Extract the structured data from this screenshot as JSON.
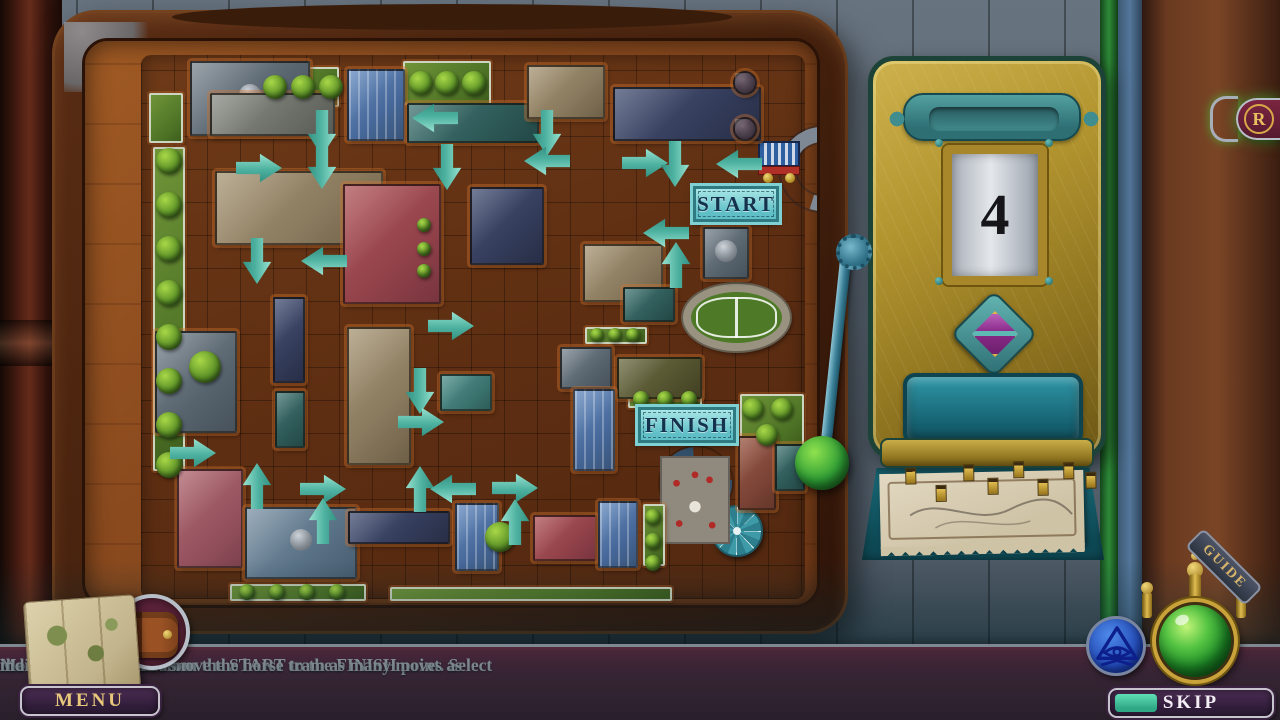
{
  "colors": {
    "arrow_teal": "#4fb8a8",
    "machine_gold": "#b3952f",
    "bar_maroon": "#6b1f33",
    "orb_green": "#2ea03a",
    "sign_teal": "#8adde0",
    "eye_blue": "#1b3fae"
  },
  "instructions": {
    "lines": [
      "Move the horse tram from the START to the FINISH point. Select",
      "the number buttons to move the horse tram as many moves as",
      "indicated by the arrows."
    ]
  },
  "board": {
    "start_label": "START",
    "finish_label": "FINISH",
    "arrows": [
      {
        "x": 237,
        "y": 92,
        "d": "d"
      },
      {
        "x": 237,
        "y": 125,
        "d": "d"
      },
      {
        "x": 174,
        "y": 127,
        "d": "r"
      },
      {
        "x": 362,
        "y": 126,
        "d": "d"
      },
      {
        "x": 462,
        "y": 92,
        "d": "d"
      },
      {
        "x": 462,
        "y": 120,
        "d": "l"
      },
      {
        "x": 560,
        "y": 122,
        "d": "r"
      },
      {
        "x": 590,
        "y": 123,
        "d": "d"
      },
      {
        "x": 654,
        "y": 123,
        "d": "l"
      },
      {
        "x": 350,
        "y": 77,
        "d": "l"
      },
      {
        "x": 172,
        "y": 220,
        "d": "d"
      },
      {
        "x": 239,
        "y": 220,
        "d": "l"
      },
      {
        "x": 581,
        "y": 192,
        "d": "l"
      },
      {
        "x": 591,
        "y": 224,
        "d": "u"
      },
      {
        "x": 366,
        "y": 285,
        "d": "r"
      },
      {
        "x": 335,
        "y": 350,
        "d": "d"
      },
      {
        "x": 336,
        "y": 381,
        "d": "r"
      },
      {
        "x": 108,
        "y": 412,
        "d": "r"
      },
      {
        "x": 172,
        "y": 445,
        "d": "u"
      },
      {
        "x": 238,
        "y": 448,
        "d": "r"
      },
      {
        "x": 335,
        "y": 448,
        "d": "u"
      },
      {
        "x": 368,
        "y": 448,
        "d": "l"
      },
      {
        "x": 430,
        "y": 447,
        "d": "r"
      },
      {
        "x": 238,
        "y": 480,
        "d": "u"
      },
      {
        "x": 430,
        "y": 481,
        "d": "u"
      }
    ],
    "buildings": [
      {
        "x": 105,
        "y": 20,
        "w": 120,
        "h": 75,
        "c": "slate",
        "dome": true
      },
      {
        "x": 125,
        "y": 52,
        "w": 125,
        "h": 43,
        "c": "slate2"
      },
      {
        "x": 262,
        "y": 28,
        "w": 58,
        "h": 72,
        "c": "blue"
      },
      {
        "x": 322,
        "y": 62,
        "w": 132,
        "h": 40,
        "c": "dteal"
      },
      {
        "x": 442,
        "y": 24,
        "w": 78,
        "h": 54,
        "c": "tan"
      },
      {
        "x": 528,
        "y": 46,
        "w": 148,
        "h": 54,
        "c": "navy"
      },
      {
        "x": 648,
        "y": 30,
        "w": 24,
        "h": 24,
        "c": "plum"
      },
      {
        "x": 648,
        "y": 76,
        "w": 24,
        "h": 24,
        "c": "plum"
      },
      {
        "x": 130,
        "y": 130,
        "w": 168,
        "h": 74,
        "c": "tan"
      },
      {
        "x": 258,
        "y": 143,
        "w": 98,
        "h": 120,
        "c": "red"
      },
      {
        "x": 385,
        "y": 146,
        "w": 74,
        "h": 78,
        "c": "navy"
      },
      {
        "x": 618,
        "y": 186,
        "w": 46,
        "h": 52,
        "c": "slate",
        "dome": true
      },
      {
        "x": 70,
        "y": 290,
        "w": 82,
        "h": 102,
        "c": "slate"
      },
      {
        "x": 188,
        "y": 256,
        "w": 32,
        "h": 86,
        "c": "navy"
      },
      {
        "x": 190,
        "y": 350,
        "w": 30,
        "h": 57,
        "c": "dteal"
      },
      {
        "x": 262,
        "y": 286,
        "w": 64,
        "h": 138,
        "c": "tan"
      },
      {
        "x": 355,
        "y": 333,
        "w": 52,
        "h": 37,
        "c": "teal"
      },
      {
        "x": 498,
        "y": 203,
        "w": 80,
        "h": 58,
        "c": "tan"
      },
      {
        "x": 538,
        "y": 246,
        "w": 52,
        "h": 35,
        "c": "dteal"
      },
      {
        "x": 475,
        "y": 306,
        "w": 52,
        "h": 42,
        "c": "slate"
      },
      {
        "x": 532,
        "y": 316,
        "w": 85,
        "h": 42,
        "c": "olive"
      },
      {
        "x": 488,
        "y": 348,
        "w": 42,
        "h": 82,
        "c": "blue"
      },
      {
        "x": 92,
        "y": 428,
        "w": 66,
        "h": 99,
        "c": "pink"
      },
      {
        "x": 160,
        "y": 466,
        "w": 112,
        "h": 72,
        "c": "steel",
        "dome": true
      },
      {
        "x": 263,
        "y": 470,
        "w": 102,
        "h": 33,
        "c": "navy"
      },
      {
        "x": 370,
        "y": 462,
        "w": 44,
        "h": 68,
        "c": "blue"
      },
      {
        "x": 448,
        "y": 474,
        "w": 64,
        "h": 46,
        "c": "red"
      },
      {
        "x": 513,
        "y": 460,
        "w": 40,
        "h": 67,
        "c": "blue"
      },
      {
        "x": 653,
        "y": 395,
        "w": 38,
        "h": 74,
        "c": "brick"
      },
      {
        "x": 690,
        "y": 403,
        "w": 30,
        "h": 47,
        "c": "dteal"
      }
    ],
    "hedges": [
      {
        "x": 68,
        "y": 106,
        "w": 32,
        "h": 324
      },
      {
        "x": 64,
        "y": 52,
        "w": 34,
        "h": 50
      },
      {
        "x": 168,
        "y": 26,
        "w": 86,
        "h": 40
      },
      {
        "x": 318,
        "y": 20,
        "w": 88,
        "h": 44
      },
      {
        "x": 330,
        "y": 172,
        "w": 18,
        "h": 62
      },
      {
        "x": 500,
        "y": 286,
        "w": 62,
        "h": 17
      },
      {
        "x": 543,
        "y": 350,
        "w": 74,
        "h": 17
      },
      {
        "x": 558,
        "y": 463,
        "w": 22,
        "h": 62
      },
      {
        "x": 655,
        "y": 353,
        "w": 64,
        "h": 54
      },
      {
        "x": 145,
        "y": 543,
        "w": 136,
        "h": 17
      },
      {
        "x": 305,
        "y": 546,
        "w": 282,
        "h": 14
      }
    ],
    "trees": [
      {
        "x": 84,
        "y": 120,
        "r": 13
      },
      {
        "x": 84,
        "y": 164,
        "r": 13
      },
      {
        "x": 84,
        "y": 208,
        "r": 13
      },
      {
        "x": 84,
        "y": 252,
        "r": 13
      },
      {
        "x": 84,
        "y": 296,
        "r": 13
      },
      {
        "x": 84,
        "y": 340,
        "r": 13
      },
      {
        "x": 84,
        "y": 384,
        "r": 13
      },
      {
        "x": 84,
        "y": 424,
        "r": 13
      },
      {
        "x": 190,
        "y": 46,
        "r": 12
      },
      {
        "x": 218,
        "y": 46,
        "r": 12
      },
      {
        "x": 246,
        "y": 46,
        "r": 12
      },
      {
        "x": 336,
        "y": 42,
        "r": 12
      },
      {
        "x": 362,
        "y": 42,
        "r": 12
      },
      {
        "x": 389,
        "y": 42,
        "r": 12
      },
      {
        "x": 120,
        "y": 326,
        "r": 16
      },
      {
        "x": 415,
        "y": 496,
        "r": 15
      },
      {
        "x": 512,
        "y": 294,
        "r": 7
      },
      {
        "x": 530,
        "y": 294,
        "r": 7
      },
      {
        "x": 548,
        "y": 294,
        "r": 7
      },
      {
        "x": 556,
        "y": 358,
        "r": 8
      },
      {
        "x": 580,
        "y": 358,
        "r": 8
      },
      {
        "x": 604,
        "y": 358,
        "r": 8
      },
      {
        "x": 668,
        "y": 368,
        "r": 11
      },
      {
        "x": 697,
        "y": 368,
        "r": 11
      },
      {
        "x": 682,
        "y": 394,
        "r": 11
      },
      {
        "x": 568,
        "y": 476,
        "r": 8
      },
      {
        "x": 568,
        "y": 500,
        "r": 8
      },
      {
        "x": 568,
        "y": 522,
        "r": 8
      },
      {
        "x": 162,
        "y": 551,
        "r": 8
      },
      {
        "x": 192,
        "y": 551,
        "r": 8
      },
      {
        "x": 222,
        "y": 551,
        "r": 8
      },
      {
        "x": 252,
        "y": 551,
        "r": 8
      },
      {
        "x": 339,
        "y": 184,
        "r": 7
      },
      {
        "x": 339,
        "y": 208,
        "r": 7
      },
      {
        "x": 339,
        "y": 230,
        "r": 7
      }
    ],
    "landmarks": {
      "stadium": {
        "x": 598,
        "y": 243,
        "w": 107,
        "h": 67
      },
      "roundabout": {
        "x": 575,
        "y": 406,
        "s": 72
      },
      "umbrella": {
        "x": 626,
        "y": 464,
        "s": 52
      },
      "plaza": {
        "x": 575,
        "y": 415,
        "w": 70,
        "h": 88
      },
      "tram": {
        "x": 673,
        "y": 98
      },
      "pipe": {
        "x": 695,
        "y": 86
      },
      "start_sign": {
        "x": 608,
        "y": 145,
        "w": 86,
        "h": 36
      },
      "finish_sign": {
        "x": 553,
        "y": 366,
        "w": 98,
        "h": 36
      }
    }
  },
  "machine": {
    "display_value": "4",
    "pegs": [
      {
        "x": 26,
        "y": 4
      },
      {
        "x": 56,
        "y": 22
      },
      {
        "x": 84,
        "y": 2
      },
      {
        "x": 108,
        "y": 16
      },
      {
        "x": 134,
        "y": 0
      },
      {
        "x": 158,
        "y": 18
      },
      {
        "x": 184,
        "y": 2
      },
      {
        "x": 206,
        "y": 12
      }
    ]
  },
  "hud": {
    "menu_label": "MENU",
    "skip_label": "SKIP",
    "guide_label": "GUIDE",
    "replay_label": "R",
    "skip_progress": 0.26
  }
}
